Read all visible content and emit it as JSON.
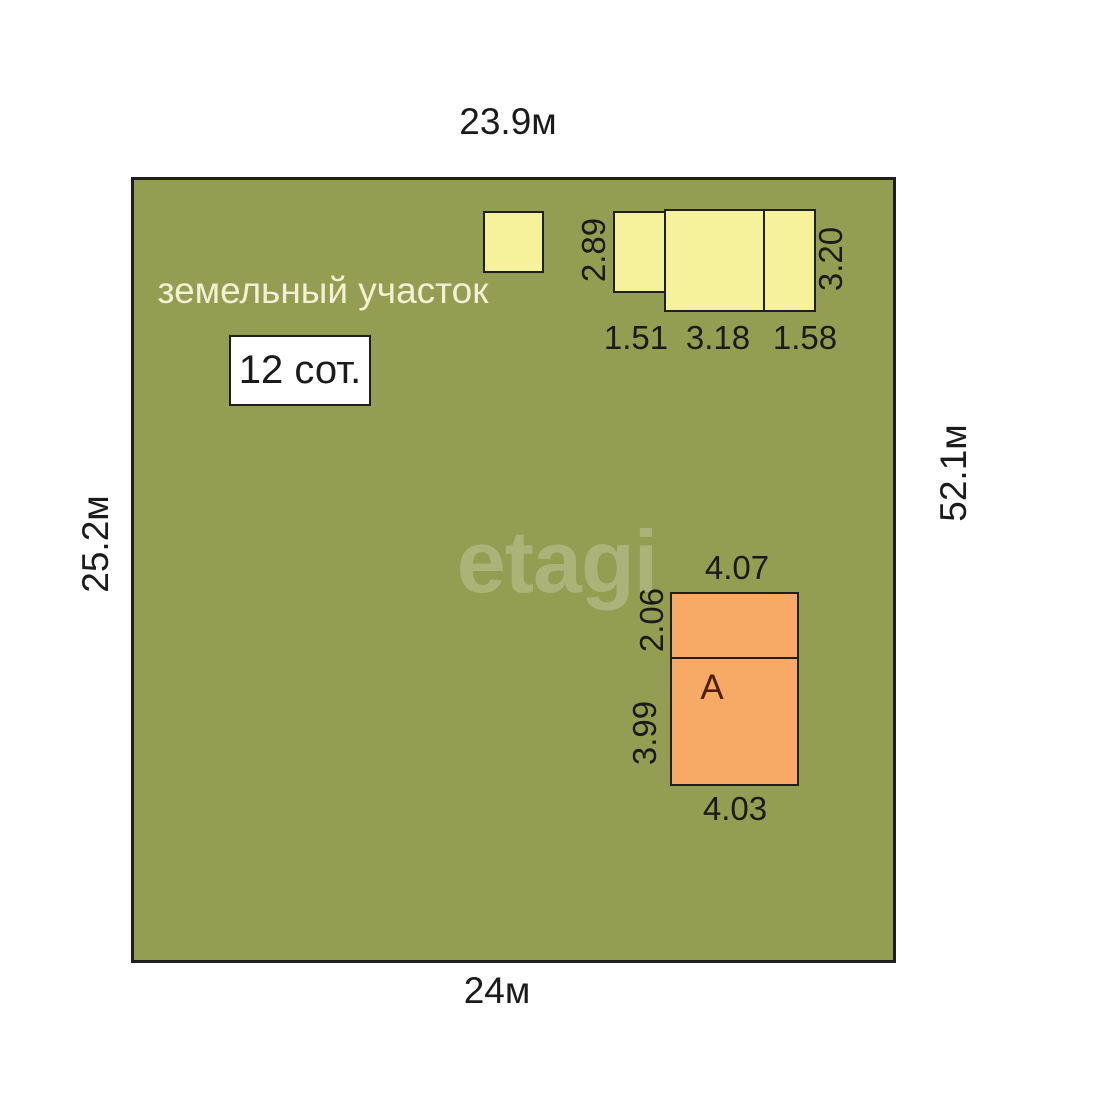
{
  "plot": {
    "name_label": "земельный участок",
    "area_label": "12 сот.",
    "dim_top": "23.9м",
    "dim_bottom": "24м",
    "dim_left": "25.2м",
    "dim_right": "52.1м"
  },
  "outbuildings": {
    "dim_height_left": "2.89",
    "dim_height_right": "3.20",
    "dim_width_left": "1.51",
    "dim_width_middle": "3.18",
    "dim_width_right": "1.58"
  },
  "house": {
    "letter": "А",
    "dim_width_top": "4.07",
    "dim_height_top": "2.06",
    "dim_height_bottom": "3.99",
    "dim_width_bottom": "4.03"
  },
  "watermark": "etagi",
  "colors": {
    "plot_fill": "#949e52",
    "yellow_building": "#f6f29c",
    "orange_building": "#f7aa66",
    "outline": "#1f1f1f",
    "dimension_text": "#1b1b1b",
    "plot_name_text": "#f3f0d4",
    "house_letter_text": "#4f1d12",
    "background": "#ffffff"
  }
}
